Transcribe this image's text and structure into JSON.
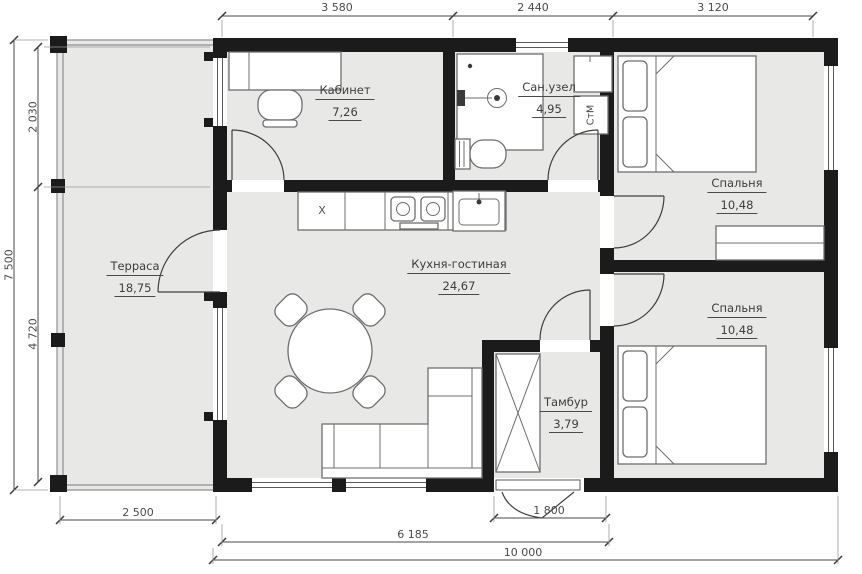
{
  "image_type": "floor_plan",
  "rooms": [
    {
      "id": "terrace",
      "name": "Терраса",
      "area": "18,75"
    },
    {
      "id": "office",
      "name": "Кабинет",
      "area": "7,26"
    },
    {
      "id": "bathroom",
      "name": "Сан.узел",
      "area": "4,95"
    },
    {
      "id": "kitchen_living",
      "name": "Кухня-гостиная",
      "area": "24,67"
    },
    {
      "id": "vestibule",
      "name": "Тамбур",
      "area": "3,79"
    },
    {
      "id": "bedroom_top",
      "name": "Спальня",
      "area": "10,48"
    },
    {
      "id": "bedroom_bottom",
      "name": "Спальня",
      "area": "10,48"
    }
  ],
  "markers": {
    "washing_machine": "СтМ",
    "kitchen_x": "X"
  },
  "dimensions": {
    "top": [
      "3 580",
      "2 440",
      "3 120"
    ],
    "left": {
      "total": "7 500",
      "upper": "2 030",
      "lower": "4 720"
    },
    "bottom": {
      "terrace_width": "2 500",
      "entrance_width": "1 800",
      "living_width": "6 185",
      "total_width": "10 000"
    }
  },
  "colors": {
    "wall": "#1b1b1b",
    "floor": "#e8e8e7",
    "furniture_stroke": "#6e6e6e",
    "dimension_text": "#4a4a4a"
  }
}
